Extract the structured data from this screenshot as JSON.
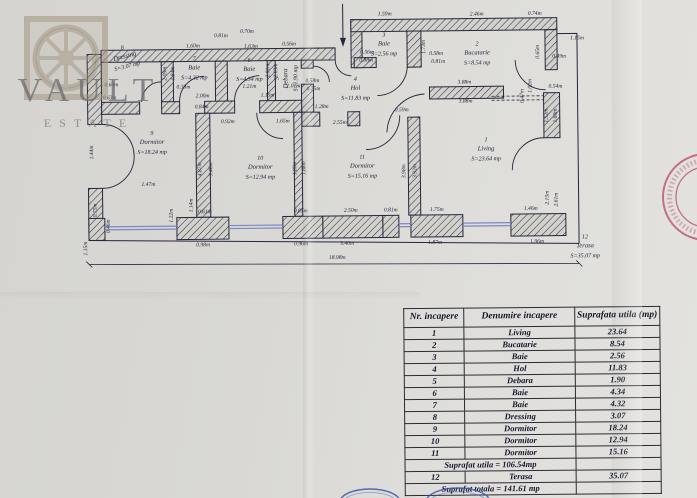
{
  "watermark": {
    "title": "VAULT",
    "subtitle": "ESTATE"
  },
  "plan": {
    "rooms": [
      {
        "num": "8",
        "name": "Dressing",
        "area": "S=3.07 mp",
        "x": 126,
        "y": 56,
        "r": -14
      },
      {
        "num": "7",
        "name": "Baie",
        "area": "S=4.32 mp",
        "x": 195,
        "y": 68,
        "r": 0
      },
      {
        "num": "6",
        "name": "Baie",
        "area": "S=4.34 mp",
        "x": 250,
        "y": 70,
        "r": 0
      },
      {
        "num": "5",
        "name": "Debara",
        "area": "S=1.90 mp",
        "x": 288,
        "y": 78,
        "r": -90
      },
      {
        "num": "3",
        "name": "Baie",
        "area": "S=2.56 mp",
        "x": 385,
        "y": 46,
        "r": 0
      },
      {
        "num": "2",
        "name": "Bucatarie",
        "area": "S=8.54 mp",
        "x": 478,
        "y": 56,
        "r": 0
      },
      {
        "num": "4",
        "name": "Hol",
        "area": "S=11.83 mp",
        "x": 356,
        "y": 90,
        "r": 0
      },
      {
        "num": "9",
        "name": "Dormitor",
        "area": "S=18.24 mp",
        "x": 152,
        "y": 142,
        "r": 0
      },
      {
        "num": "10",
        "name": "Dormitor",
        "area": "S=12.94 mp",
        "x": 260,
        "y": 168,
        "r": 0
      },
      {
        "num": "11",
        "name": "Dormitor",
        "area": "S=15.16 mp",
        "x": 362,
        "y": 168,
        "r": 0
      },
      {
        "num": "1",
        "name": "Living",
        "area": "S=23.64 mp",
        "x": 486,
        "y": 152,
        "r": 0
      },
      {
        "num": "12",
        "name": "Terasa",
        "area": "S=35.07 mp",
        "x": 584,
        "y": 250,
        "r": 0
      }
    ],
    "dims": [
      [
        "1.60m",
        194,
        46,
        0
      ],
      [
        "0.81m",
        222,
        36,
        0
      ],
      [
        "0.70m",
        248,
        32,
        0
      ],
      [
        "1.63m",
        252,
        47,
        0
      ],
      [
        "0.56m",
        290,
        45,
        0
      ],
      [
        "1.59m",
        386,
        16,
        0
      ],
      [
        "2.46m",
        478,
        17,
        0
      ],
      [
        "0.74m",
        536,
        17,
        0
      ],
      [
        "1.15m",
        578,
        42,
        0
      ],
      [
        "0.49m",
        560,
        60,
        0
      ],
      [
        "0.65m",
        540,
        54,
        -90
      ],
      [
        "1.73m",
        426,
        48,
        -90
      ],
      [
        "0.56m",
        368,
        54,
        0
      ],
      [
        "0.88m",
        367,
        62,
        0
      ],
      [
        "0.58m",
        437,
        56,
        0
      ],
      [
        "0.81m",
        439,
        64,
        0
      ],
      [
        "3.88m",
        465,
        85,
        0
      ],
      [
        "3.88m",
        466,
        104,
        0
      ],
      [
        "0.54m",
        556,
        90,
        0
      ],
      [
        "1.52m",
        548,
        118,
        -90
      ],
      [
        "1.60m",
        557,
        118,
        -90
      ],
      [
        "1.02m",
        532,
        88,
        -90
      ],
      [
        "0.47m",
        524,
        98,
        -90
      ],
      [
        "2.15m",
        548,
        200,
        -90
      ],
      [
        "2.61m",
        557,
        202,
        -90
      ],
      [
        "0.33m",
        184,
        87,
        0
      ],
      [
        "2.00m",
        203,
        96,
        0
      ],
      [
        "0.84m",
        202,
        107,
        0
      ],
      [
        "1.21m",
        250,
        87,
        0
      ],
      [
        "1.15m",
        268,
        96,
        0
      ],
      [
        "1.01m",
        294,
        87,
        0
      ],
      [
        "0.58m",
        313,
        82,
        0
      ],
      [
        "0.75m",
        314,
        90,
        0
      ],
      [
        "1.28m",
        322,
        108,
        0
      ],
      [
        "2.55m",
        340,
        124,
        0
      ],
      [
        "0.92m",
        228,
        122,
        0
      ],
      [
        "1.65m",
        283,
        122,
        0
      ],
      [
        "0.59m",
        402,
        112,
        0
      ],
      [
        "4.87m",
        201,
        168,
        -90
      ],
      [
        "3.46m",
        212,
        168,
        -90
      ],
      [
        "1.80m",
        296,
        168,
        -90
      ],
      [
        "1.88m",
        305,
        168,
        -90
      ],
      [
        "3.98m",
        405,
        172,
        -90
      ],
      [
        "3.92m",
        416,
        172,
        -90
      ],
      [
        "2.09m",
        167,
        72,
        -90
      ],
      [
        "1.84m",
        175,
        72,
        -90
      ],
      [
        "2.01m",
        270,
        70,
        -90
      ],
      [
        "2.03m",
        278,
        70,
        -90
      ],
      [
        "0.64m",
        112,
        84,
        0
      ],
      [
        "0.63m",
        110,
        97,
        0
      ],
      [
        "1.44m",
        93,
        150,
        -90
      ],
      [
        "0.75m",
        96,
        208,
        -90
      ],
      [
        "0.46m",
        109,
        224,
        -90
      ],
      [
        "1.15m",
        86,
        246,
        -90
      ],
      [
        "1.47m",
        148,
        184,
        0
      ],
      [
        "1.22m",
        172,
        214,
        -90
      ],
      [
        "1.14m",
        192,
        204,
        -90
      ],
      [
        "0.61m",
        204,
        212,
        0
      ],
      [
        "0.98m",
        202,
        245,
        0
      ],
      [
        "0.85m",
        300,
        212,
        0
      ],
      [
        "0.96m",
        300,
        245,
        0
      ],
      [
        "2.50m",
        350,
        212,
        0
      ],
      [
        "3.40m",
        346,
        245,
        0
      ],
      [
        "0.81m",
        390,
        212,
        0
      ],
      [
        "1.75m",
        436,
        212,
        0
      ],
      [
        "1.87m",
        434,
        245,
        0
      ],
      [
        "1.46m",
        530,
        212,
        0
      ],
      [
        "1.96m",
        536,
        245,
        0
      ],
      [
        "18.98m",
        336,
        259,
        0
      ]
    ]
  },
  "table": {
    "headers": [
      "Nr. incapere",
      "Denumire incapere",
      "Suprafata utila (mp)"
    ],
    "rows": [
      [
        "1",
        "Living",
        "23.64"
      ],
      [
        "2",
        "Bucatarie",
        "8.54"
      ],
      [
        "3",
        "Baie",
        "2.56"
      ],
      [
        "4",
        "Hol",
        "11.83"
      ],
      [
        "5",
        "Debara",
        "1.90"
      ],
      [
        "6",
        "Baie",
        "4.34"
      ],
      [
        "7",
        "Baie",
        "4.32"
      ],
      [
        "8",
        "Dressing",
        "3.07"
      ],
      [
        "9",
        "Dormitor",
        "18.24"
      ],
      [
        "10",
        "Dormitor",
        "12.94"
      ],
      [
        "11",
        "Dormitor",
        "15.16"
      ]
    ],
    "subtotal": "Suprafat utila = 106.54mp",
    "terasa_row": [
      "12",
      "Terasa",
      "35.07"
    ],
    "total": "Suprafat totala = 141.61 mp"
  },
  "colors": {
    "ink": "#26263c",
    "window": "#7d88c6",
    "stamp_red": "#b84a68",
    "stamp_blue": "#3c55a8"
  }
}
